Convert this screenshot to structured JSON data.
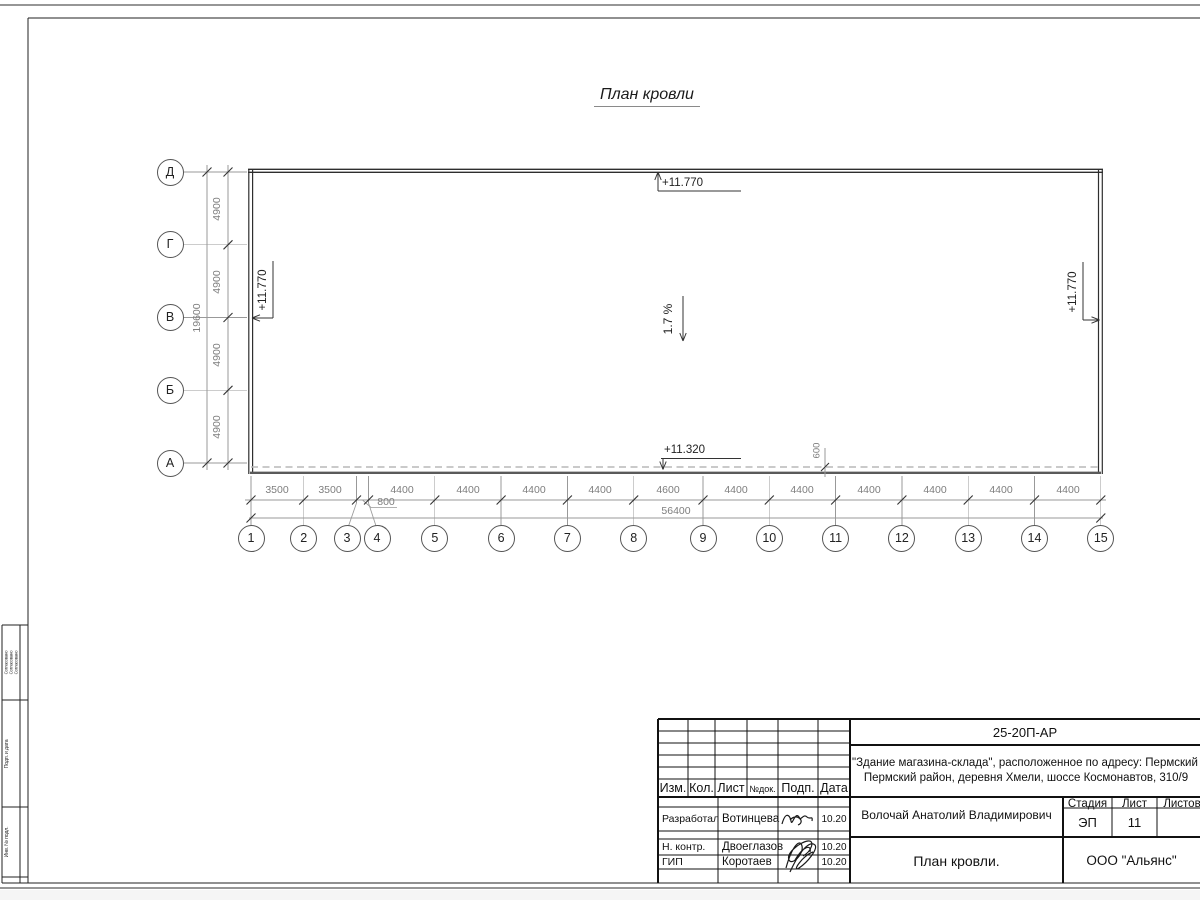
{
  "title": "План кровли",
  "roof": {
    "elevation_top": "+11.770",
    "elevation_left": "+11.770",
    "elevation_right": "+11.770",
    "elevation_low": "+11.320",
    "slope": "1.7 %",
    "overhang_dim": "600"
  },
  "axes": {
    "cols": [
      "1",
      "2",
      "3",
      "4",
      "5",
      "6",
      "7",
      "8",
      "9",
      "10",
      "11",
      "12",
      "13",
      "14",
      "15"
    ],
    "rows": [
      "Д",
      "Г",
      "В",
      "Б",
      "А"
    ]
  },
  "dims": {
    "bottom": [
      "3500",
      "3500",
      "800",
      "4400",
      "4400",
      "4400",
      "4400",
      "4600",
      "4400",
      "4400",
      "4400",
      "4400",
      "4400",
      "4400"
    ],
    "bottom_total": "56400",
    "left": [
      "4900",
      "4900",
      "4900",
      "4900"
    ],
    "left_total": "19600"
  },
  "title_block": {
    "doc_number": "25-20П-АР",
    "project_line1": "\"Здание магазина-склада\", расположенное по адресу: Пермский край,",
    "project_line2": "Пермский район, деревня Хмели, шоссе Космонавтов, 310/9",
    "columns": {
      "izm": "Изм.",
      "kol": "Кол.",
      "list": "Лист",
      "doc": "№док.",
      "podp": "Подп.",
      "data": "Дата"
    },
    "rows": [
      {
        "role": "Разработал",
        "name": "Вотинцева",
        "date": "10.20"
      },
      {
        "role": "Н. контр.",
        "name": "Двоеглазов",
        "date": "10.20"
      },
      {
        "role": "ГИП",
        "name": "Коротаев",
        "date": "10.20"
      }
    ],
    "client": "Волочай Анатолий Владимирович",
    "stage_label": "Стадия",
    "sheet_label": "Лист",
    "sheets_label": "Листов",
    "stage_value": "ЭП",
    "sheet_value": "11",
    "sheet_title": "План кровли.",
    "company": "ООО \"Альянс\""
  },
  "side_stamp": {
    "approvals_1": "Согласовано",
    "approvals_2": "Согласовано",
    "approvals_3": "Согласовано",
    "cell2_label": "Подп. и дата",
    "cell3_label": "Инв. № подл."
  }
}
